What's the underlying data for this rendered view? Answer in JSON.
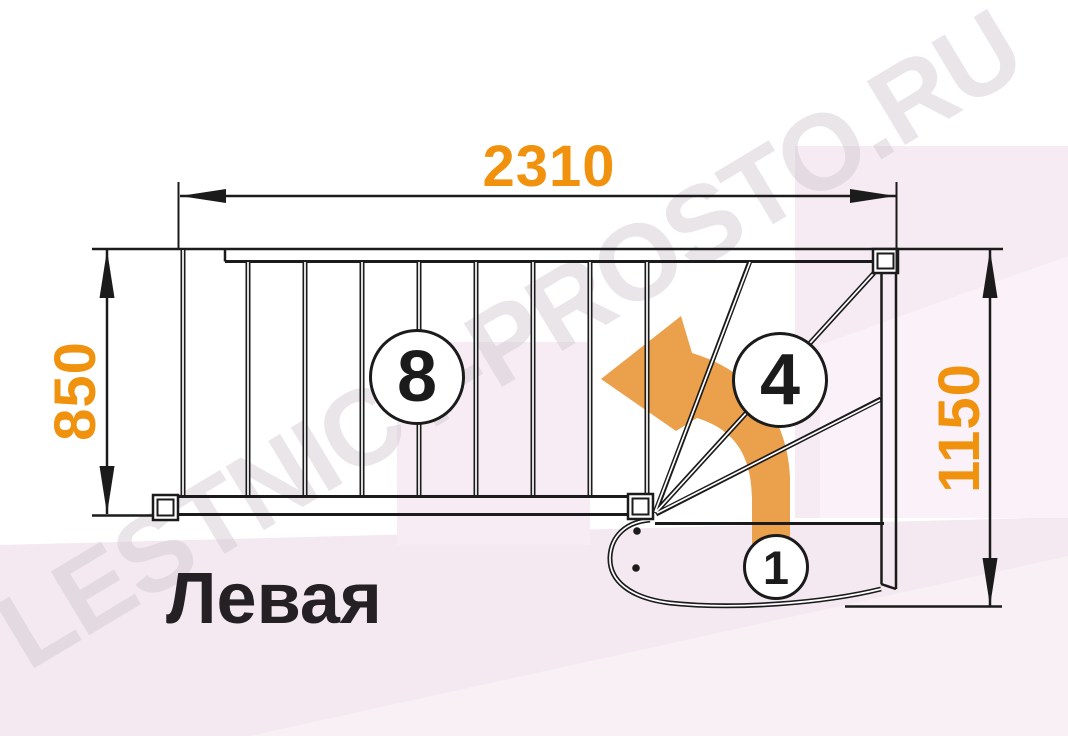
{
  "diagram": {
    "plan_title": "Левая",
    "watermark_text": "LESTNICY-PROSTO.RU",
    "dimensions_mm": {
      "total_length": "2310",
      "flight_width": "850",
      "turn_width": "1150"
    },
    "step_markers": [
      {
        "id": "straight-flight-steps",
        "label": "8"
      },
      {
        "id": "winder-steps",
        "label": "4"
      },
      {
        "id": "first-step",
        "label": "1"
      }
    ],
    "colors": {
      "dimension_text": "#F0920E",
      "direction_arrow": "#EBA04C",
      "linework": "#1B1B1B",
      "background_tint": "#F4E9F1",
      "background_tint_light": "#F9F0F6",
      "watermark_text": "#CFC7CF"
    }
  }
}
